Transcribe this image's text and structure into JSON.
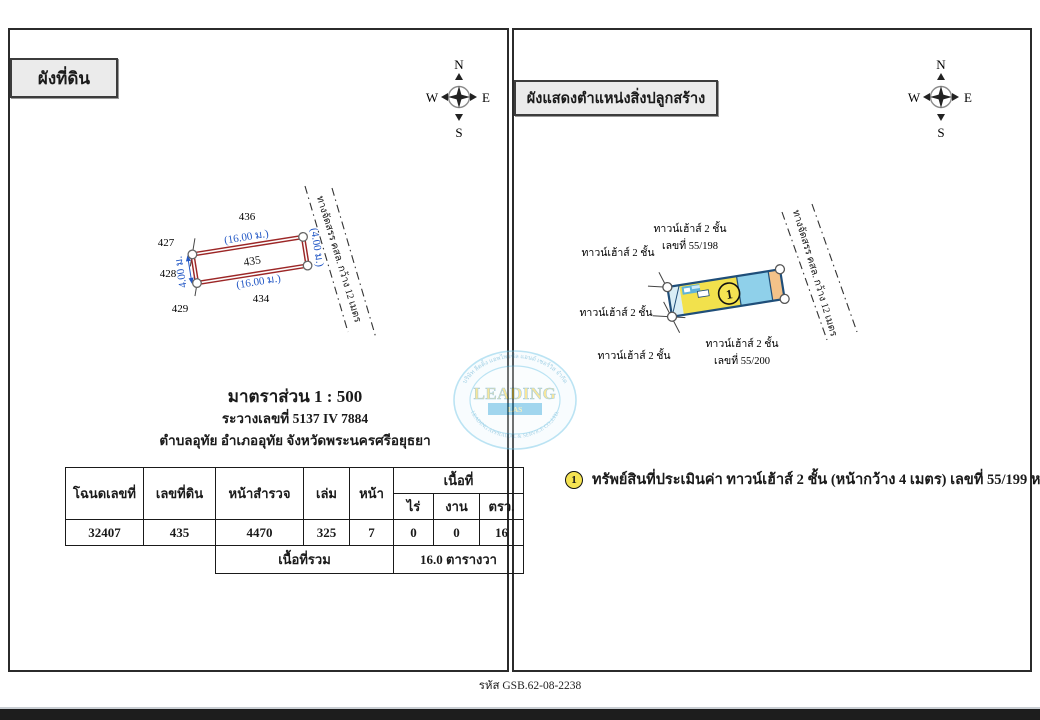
{
  "page": {
    "footer_code": "รหัส GSB.62-08-2238"
  },
  "compass": {
    "north": "N",
    "east": "E",
    "south": "S",
    "west": "W"
  },
  "left_panel": {
    "title": "ผังที่ดิน",
    "plot": {
      "parcel_number": "435",
      "neighbor_top": "436",
      "neighbor_left_top": "427",
      "neighbor_left_mid": "428",
      "neighbor_left_bottom": "429",
      "neighbor_bottom": "434",
      "dim_top": "(16.00 ม.)",
      "dim_bottom": "(16.00 ม.)",
      "dim_right": "(4.00 ม.)",
      "dim_left": "4.00 ม.",
      "road_label": "ทางจัดสรร คสล. กว้าง 12 เมตร"
    },
    "scale_title": "มาตราส่วน 1 : 500",
    "sheet_number": "ระวางเลขที่ 5137 IV 7884",
    "location": "ตำบลอุทัย อำเภออุทัย จังหวัดพระนครศรีอยุธยา",
    "table": {
      "col_deed": "โฉนดเลขที่",
      "col_parcel": "เลขที่ดิน",
      "col_survey": "หน้าสำรวจ",
      "col_volume": "เล่ม",
      "col_page": "หน้า",
      "col_area": "เนื้อที่",
      "col_rai": "ไร่",
      "col_ngan": "งาน",
      "col_wah": "ตรว.",
      "deed_no": "32407",
      "parcel_no": "435",
      "survey_page": "4470",
      "volume": "325",
      "page": "7",
      "rai": "0",
      "ngan": "0",
      "wah": "16",
      "total_label": "เนื้อที่รวม",
      "total_value": "16.0 ตารางวา"
    }
  },
  "right_panel": {
    "title": "ผังแสดงตำแหน่งสิ่งปลูกสร้าง",
    "site": {
      "marker_number": "1",
      "label_left_top": "ทาวน์เฮ้าส์ 2 ชั้น",
      "label_left_mid": "ทาวน์เฮ้าส์ 2 ชั้น",
      "label_bottom_left": "ทาวน์เฮ้าส์ 2 ชั้น",
      "label_top_line1": "ทาวน์เฮ้าส์ 2 ชั้น",
      "label_top_line2": "เลขที่ 55/198",
      "label_bottom_line1": "ทาวน์เฮ้าส์ 2 ชั้น",
      "label_bottom_line2": "เลขที่ 55/200",
      "road_label": "ทางจัดสรร คสล. กว้าง 12 เมตร"
    },
    "legend": {
      "marker_number": "1",
      "text": "ทรัพย์สินที่ประเมินค่า ทาวน์เฮ้าส์ 2 ชั้น (หน้ากว้าง 4 เมตร) เลขที่ 55/199 หมู่ที่ 4"
    }
  },
  "watermark": {
    "name": "LEADING",
    "bar_text": "LAS",
    "arc_top": "บริษัท ลีดดิ้ง แอพไพรซัล แอนด์ เซอร์วิส จำกัด",
    "arc_bottom": "LEADING APPRAISAL & SERVICE CO.,LTD."
  }
}
